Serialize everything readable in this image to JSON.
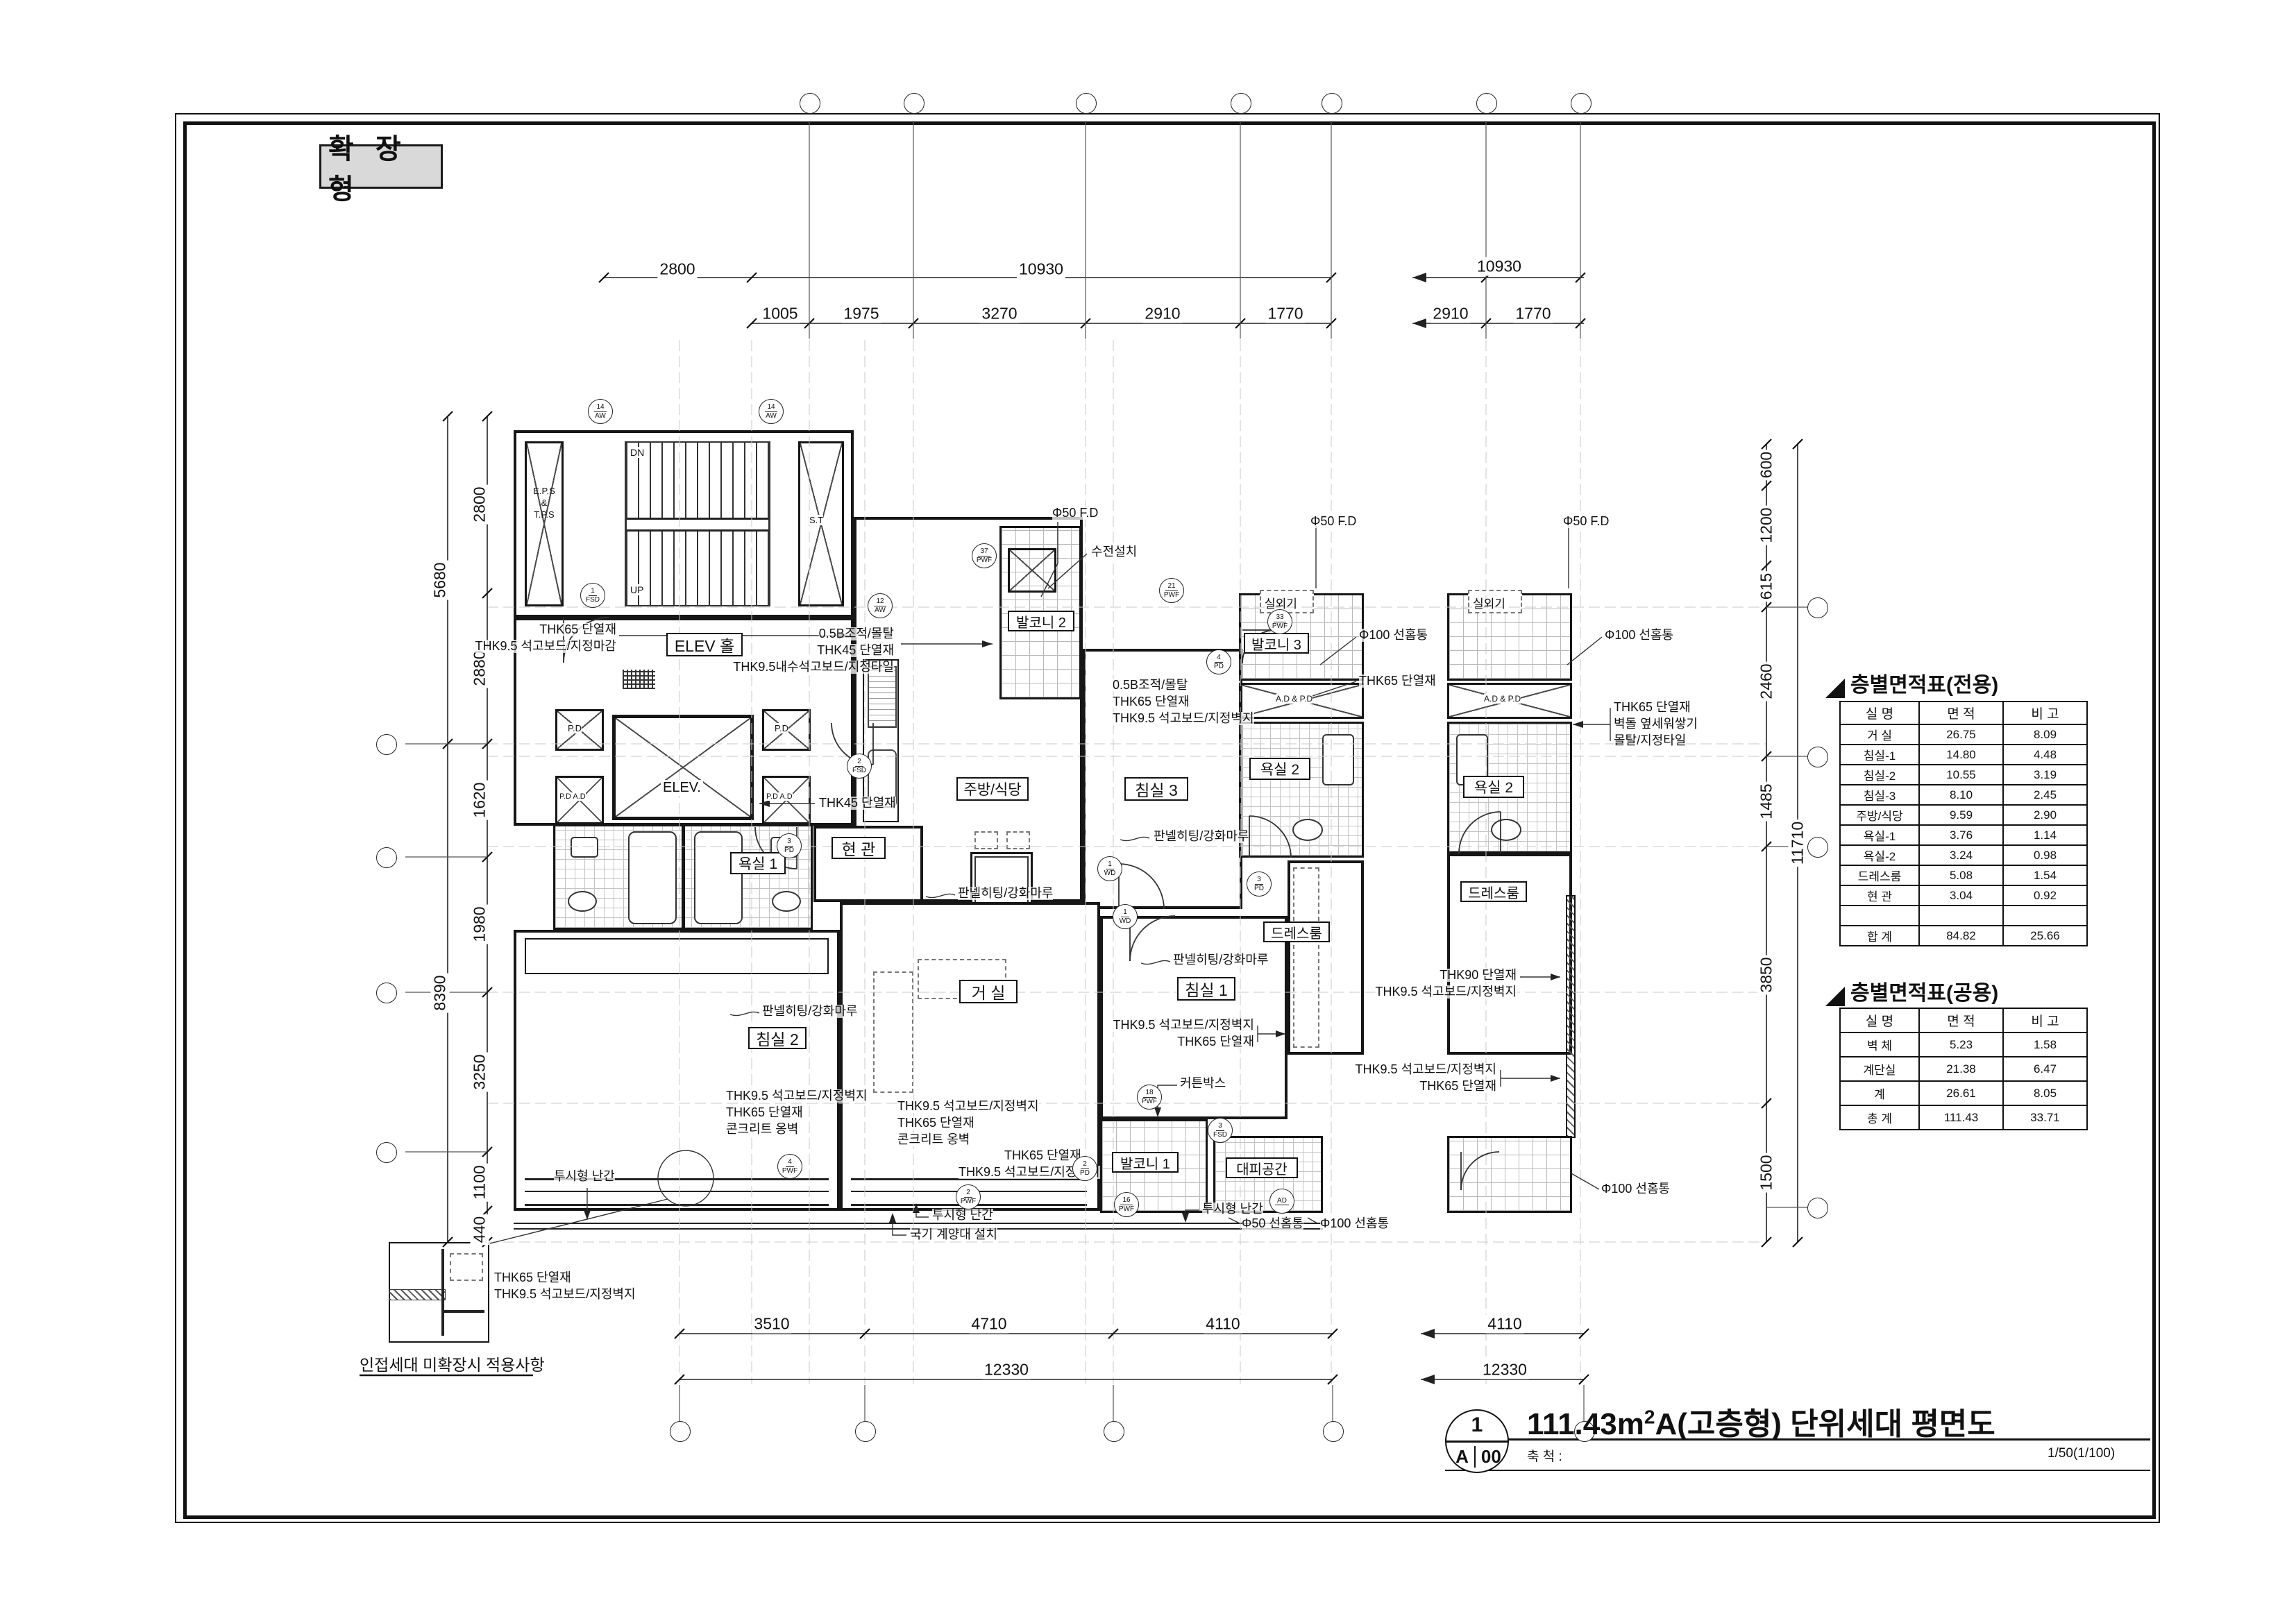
{
  "stamp": "확 장 형",
  "titleblock": {
    "num": "1",
    "sheet_l": "A",
    "sheet_r": "00",
    "title_pre": "111.43m",
    "title_sup": "2",
    "title_post": "A(고층형) 단위세대 평면도",
    "scale_label": "축 척 :",
    "scale_value": "1/50(1/100)"
  },
  "tables": {
    "exclusive": {
      "title": "층별면적표(전용)",
      "headers": [
        "실 명",
        "면 적",
        "비 고"
      ],
      "rows": [
        [
          "거 실",
          "26.75",
          "8.09"
        ],
        [
          "침실-1",
          "14.80",
          "4.48"
        ],
        [
          "침실-2",
          "10.55",
          "3.19"
        ],
        [
          "침실-3",
          "8.10",
          "2.45"
        ],
        [
          "주방/식당",
          "9.59",
          "2.90"
        ],
        [
          "욕실-1",
          "3.76",
          "1.14"
        ],
        [
          "욕실-2",
          "3.24",
          "0.98"
        ],
        [
          "드레스룸",
          "5.08",
          "1.54"
        ],
        [
          "현 관",
          "3.04",
          "0.92"
        ],
        [
          "",
          "",
          ""
        ],
        [
          "합 계",
          "84.82",
          "25.66"
        ]
      ]
    },
    "common": {
      "title": "층별면적표(공용)",
      "headers": [
        "실 명",
        "면 적",
        "비 고"
      ],
      "rows": [
        [
          "벽 체",
          "5.23",
          "1.58"
        ],
        [
          "계단실",
          "21.38",
          "6.47"
        ],
        [
          "계",
          "26.61",
          "8.05"
        ],
        [
          "총 계",
          "111.43",
          "33.71"
        ]
      ]
    }
  },
  "rooms": {
    "elev_hall": "ELEV 홀",
    "elev": "ELEV.",
    "pd": "P.D",
    "pdad": "P.D A.D",
    "adpd": "A.D & P.D",
    "st": "S.T",
    "eps1": "E.P.S",
    "eps2": "&",
    "eps3": "T.P.S",
    "dn": "DN",
    "up": "UP",
    "hyeongwan": "현 관",
    "kitchen": "주방/식당",
    "balcony2": "발코니 2",
    "bedroom3": "침실 3",
    "balcony3": "발코니 3",
    "bath2": "욕실 2",
    "dressroom": "드레스룸",
    "bath1": "욕실 1",
    "bedroom2": "침실 2",
    "living": "거 실",
    "bedroom1": "침실 1",
    "balcony1": "발코니 1",
    "shelter": "대피공간",
    "outdoor_unit": "실외기"
  },
  "anns": {
    "masonry": "0.5B조적/몰탈",
    "thk45": "THK45 단열재",
    "thk65": "THK65 단열재",
    "thk90": "THK90 단열재",
    "thk95_water": "THK9.5내수석고보드/지정타일",
    "thk95_wall": "THK9.5 석고보드/지정벽지",
    "thk95_finish": "THK9.5 석고보드/지정마감",
    "faucet": "수전설치",
    "fd50": "Φ50 F.D",
    "drain50": "Φ50 선홈통",
    "drain100": "Φ100 선홈통",
    "brick_side": "벽돌 옆세워쌓기",
    "mortar_tile": "몰탈/지정타일",
    "panel_floor": "판넬히팅/강화마루",
    "curtain": "커튼박스",
    "concrete": "콘크리트 옹벽",
    "rail": "투시형 난간",
    "flagpole": "국기 계양대 설치",
    "detail_caption": "인접세대 미확장시 적용사항"
  },
  "dims": {
    "t1a": "2800",
    "t1b": "10930",
    "t1r": "10930",
    "t2": [
      "1005",
      "1975",
      "3270",
      "2910",
      "1770"
    ],
    "t2r": [
      "2910",
      "1770"
    ],
    "lo": [
      "5680",
      "8390"
    ],
    "li": [
      "2800",
      "2880",
      "1620",
      "1980",
      "3250",
      "1100",
      "440"
    ],
    "ri": [
      "600",
      "1200",
      "615",
      "2460",
      "1485",
      "3850",
      "1500"
    ],
    "ro": "11710",
    "b1": [
      "3510",
      "4710",
      "4110"
    ],
    "b2": "12330",
    "b1r": "4110",
    "b2r": "12330"
  },
  "markers": [
    {
      "n": "14",
      "c": "AW"
    },
    {
      "n": "14",
      "c": "AW"
    },
    {
      "n": "12",
      "c": "AW"
    },
    {
      "n": "1",
      "c": "FSD"
    },
    {
      "n": "37",
      "c": "PWF"
    },
    {
      "n": "2",
      "c": "FSD"
    },
    {
      "n": "21",
      "c": "PWF"
    },
    {
      "n": "33",
      "c": "PWF"
    },
    {
      "n": "4",
      "c": "PD"
    },
    {
      "n": "1",
      "c": "WD"
    },
    {
      "n": "3",
      "c": "PD"
    },
    {
      "n": "3",
      "c": "PD"
    },
    {
      "n": "1",
      "c": "WD"
    },
    {
      "n": "18",
      "c": "PWF"
    },
    {
      "n": "2",
      "c": "PD"
    },
    {
      "n": "4",
      "c": "PWF"
    },
    {
      "n": "2",
      "c": "PWF"
    },
    {
      "n": "16",
      "c": "PWF"
    },
    {
      "n": "3",
      "c": "FSD"
    },
    {
      "n": "AD",
      "c": ""
    }
  ]
}
